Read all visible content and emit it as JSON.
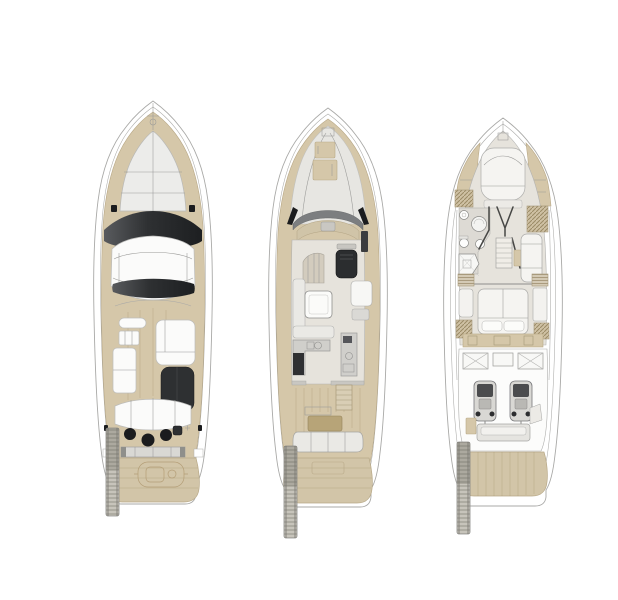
{
  "canvas": {
    "width_px": 618,
    "height_px": 600,
    "background": "#ffffff"
  },
  "figure": {
    "kind": "yacht-deck-plan-line-drawing",
    "views": [
      {
        "id": "flybridge-deck-plan",
        "position": "left"
      },
      {
        "id": "main-deck-plan",
        "position": "center"
      },
      {
        "id": "lower-deck-plan",
        "position": "right"
      }
    ]
  },
  "palette": {
    "background": "#ffffff",
    "hull_line": "#a9a9a7",
    "deck_teak": "#d5c7a9",
    "teak_line": "#b9a987",
    "platform_teak": "#d2c5a8",
    "pad_light": "#ececea",
    "pad_line": "#b9b9b7",
    "glass_dark": "#2e3032",
    "black": "#1b1c1e",
    "interior_floor": "#e6e3dc",
    "counter_gray": "#d0cfcb",
    "table_wood": "#b7a478",
    "passerelle_gray": "#c7c4bb"
  }
}
